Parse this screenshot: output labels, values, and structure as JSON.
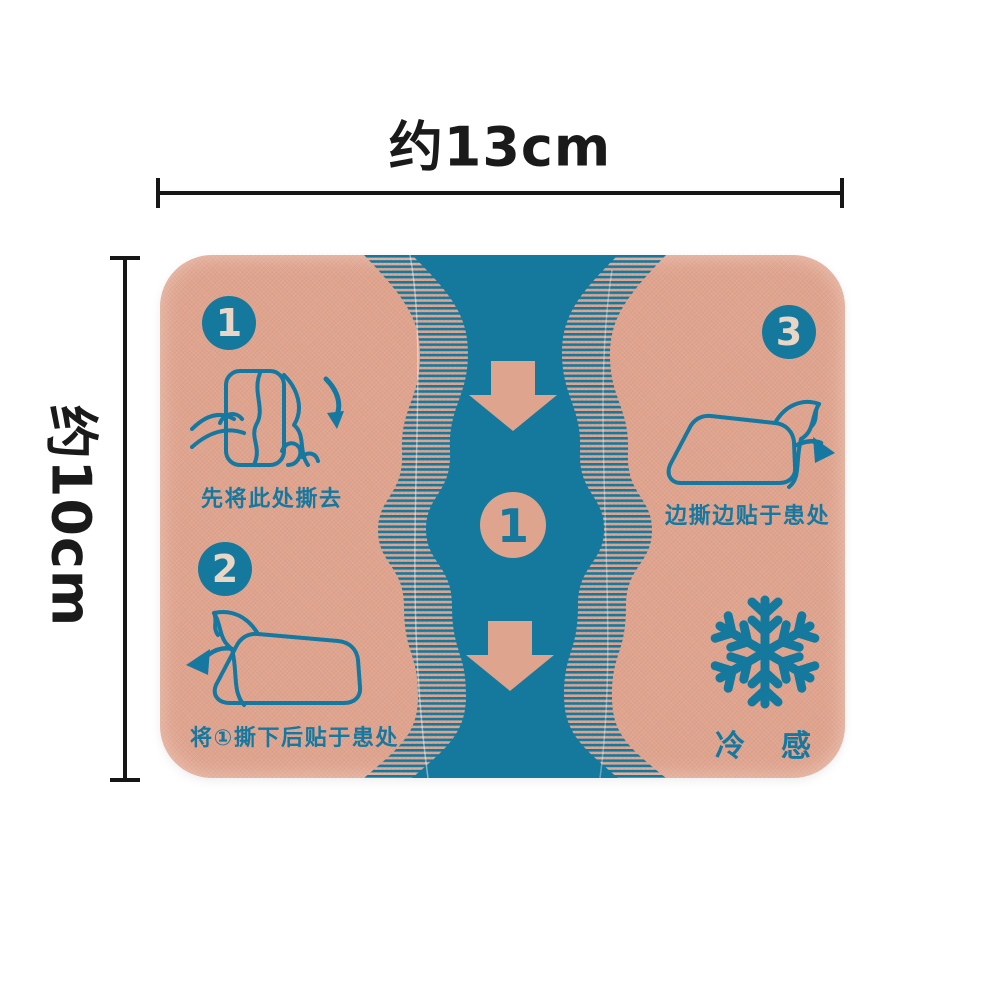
{
  "measurements": {
    "width_label": "约13cm",
    "height_label": "约10cm"
  },
  "patch": {
    "steps": [
      {
        "number": "1",
        "caption": "先将此处撕去",
        "icon": "hands-peel-icon"
      },
      {
        "number": "2",
        "caption": "将①撕下后贴于患处",
        "icon": "peel-patch-left-icon"
      },
      {
        "number": "3",
        "caption": "边撕边贴于患处",
        "icon": "peel-patch-right-icon"
      }
    ],
    "center_tab_number": "1",
    "cold_label": "冷感",
    "cold_icon": "snowflake-icon",
    "band_icons": [
      "arrow-down-icon",
      "arrow-down-icon"
    ]
  },
  "colors": {
    "background": "#ffffff",
    "patch_peach": "#dfa48e",
    "print_teal": "#15799e",
    "caption_teal": "#1578a0",
    "badge_number": "#ead6c7",
    "measure_black": "#161616"
  }
}
